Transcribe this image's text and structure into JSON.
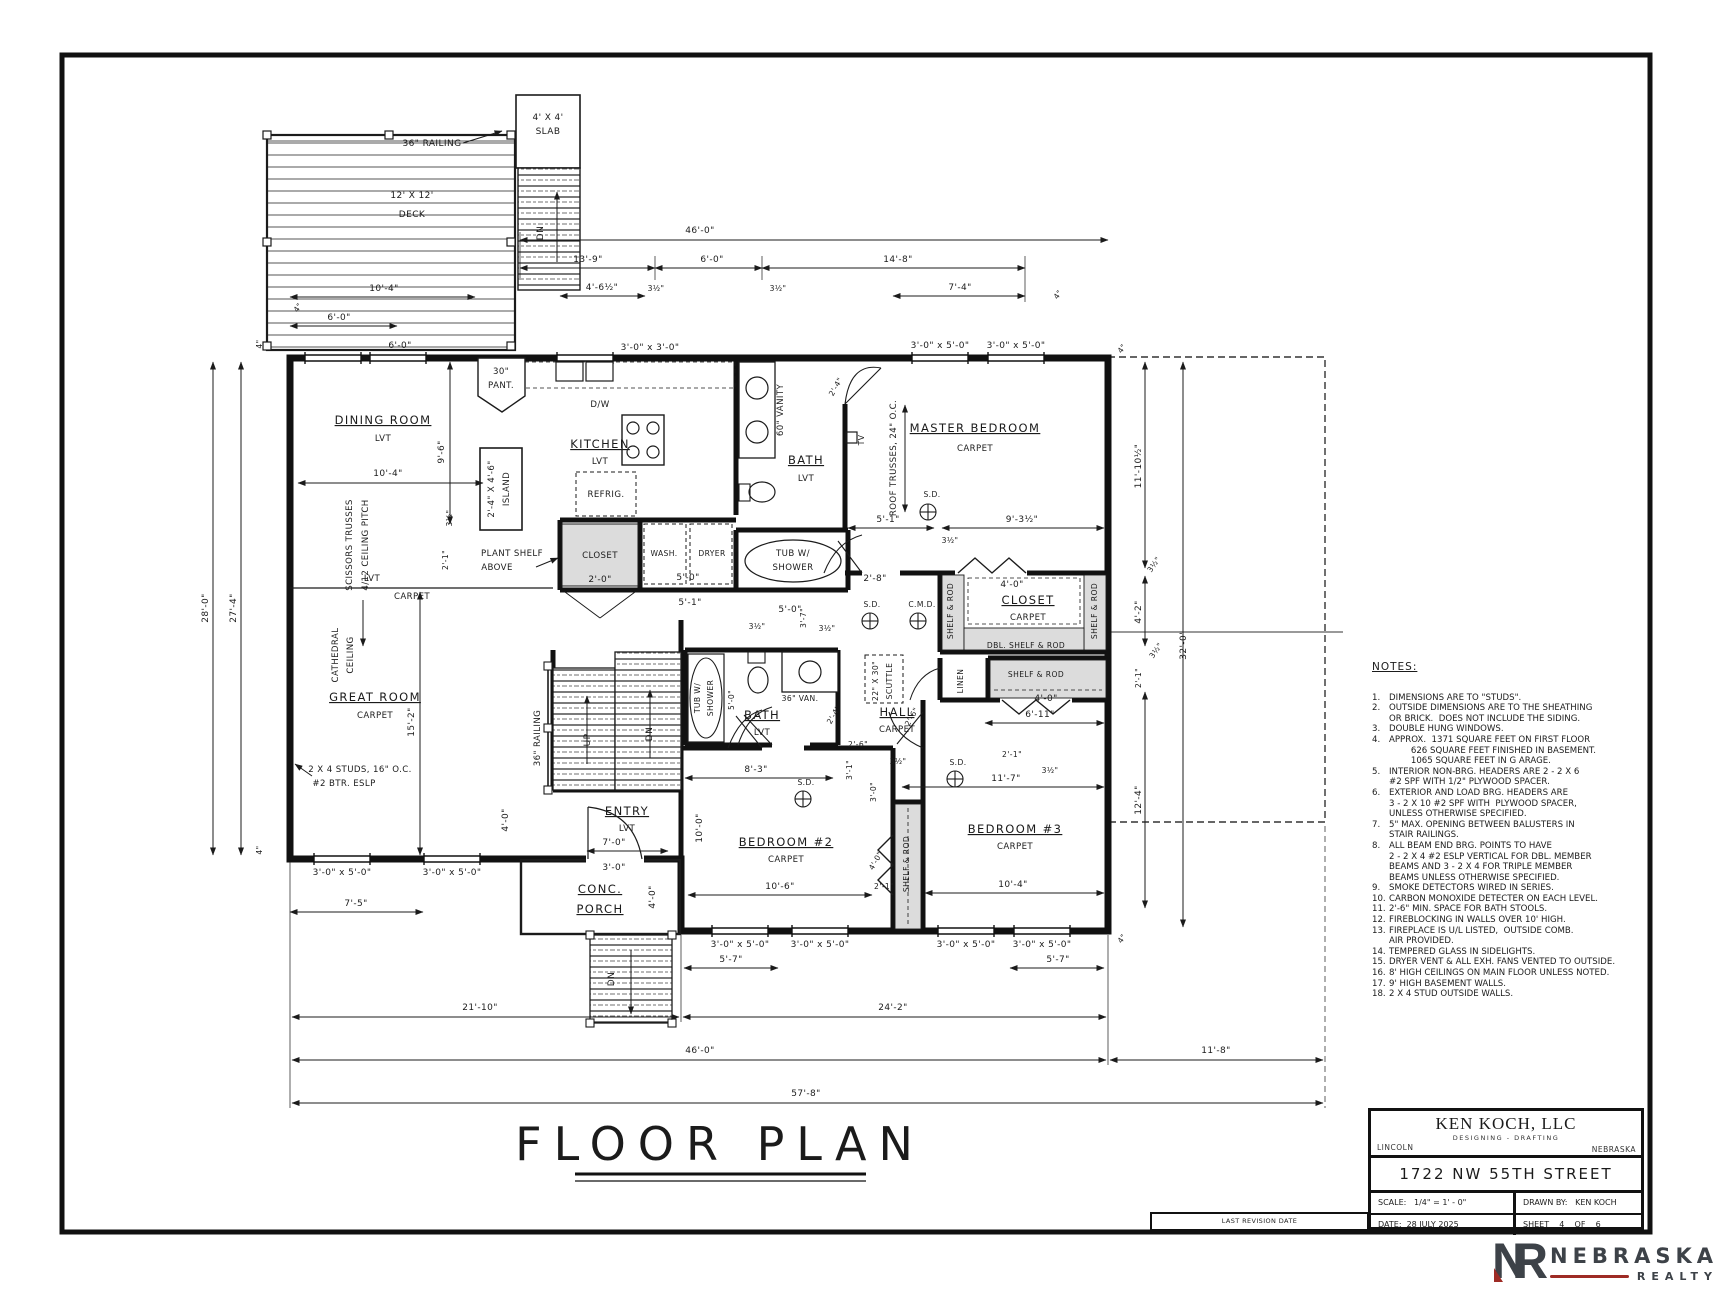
{
  "sheet": {
    "plan_title": "FLOOR PLAN"
  },
  "colors": {
    "line": "#1b1b1b",
    "shade": "#dcdcdc",
    "logo_gray": "#3d4248",
    "logo_red": "#9e2b25"
  },
  "title_block": {
    "company": "KEN KOCH, LLC",
    "company_sub": "DESIGNING - DRAFTING",
    "city": "LINCOLN",
    "state": "NEBRASKA",
    "address": "1722 NW 55TH STREET",
    "scale": "SCALE:   1/4\" = 1' - 0\"",
    "drawn_by": "DRAWN BY:   KEN KOCH",
    "date": "DATE:  28 JULY 2025",
    "sheet": "SHEET    4    OF    6",
    "revision": "LAST REVISION DATE"
  },
  "logo": {
    "monogram_n": "N",
    "monogram_r": "R",
    "name": "NEBRASKA",
    "sub": "REALTY"
  },
  "notes": {
    "title": "NOTES:",
    "items": [
      {
        "num": "1.",
        "lines": [
          "DIMENSIONS ARE TO \"STUDS\"."
        ]
      },
      {
        "num": "2.",
        "lines": [
          "OUTSIDE DIMENSIONS ARE TO THE SHEATHING",
          "OR BRICK.  DOES NOT INCLUDE THE SIDING."
        ]
      },
      {
        "num": "3.",
        "lines": [
          "DOUBLE HUNG WINDOWS."
        ]
      },
      {
        "num": "4.",
        "lines": [
          "APPROX.  1371 SQUARE FEET ON FIRST FLOOR",
          "        626 SQUARE FEET FINISHED IN BASEMENT.",
          "        1065 SQUARE FEET IN G ARAGE."
        ]
      },
      {
        "num": "5.",
        "lines": [
          "INTERIOR NON-BRG. HEADERS ARE 2 - 2 X 6",
          "#2 SPF WITH 1/2\" PLYWOOD SPACER."
        ]
      },
      {
        "num": "6.",
        "lines": [
          "EXTERIOR AND LOAD BRG. HEADERS ARE",
          "3 - 2 X 10 #2 SPF WITH  PLYWOOD SPACER,",
          "UNLESS OTHERWISE SPECIFIED."
        ]
      },
      {
        "num": "7.",
        "lines": [
          "5\" MAX. OPENING BETWEEN BALUSTERS IN",
          "STAIR RAILINGS."
        ]
      },
      {
        "num": "8.",
        "lines": [
          "ALL BEAM END BRG. POINTS TO HAVE",
          "2 - 2 X 4 #2 ESLP VERTICAL FOR DBL. MEMBER",
          "BEAMS AND 3 - 2 X 4 FOR TRIPLE MEMBER",
          "BEAMS UNLESS OTHERWISE SPECIFIED."
        ]
      },
      {
        "num": "9.",
        "lines": [
          "SMOKE DETECTORS WIRED IN SERIES."
        ]
      },
      {
        "num": "10.",
        "lines": [
          "CARBON MONOXIDE DETECTER ON EACH LEVEL."
        ]
      },
      {
        "num": "11.",
        "lines": [
          "2'-6\" MIN. SPACE FOR BATH STOOLS."
        ]
      },
      {
        "num": "12.",
        "lines": [
          "FIREBLOCKING IN WALLS OVER 10' HIGH."
        ]
      },
      {
        "num": "13.",
        "lines": [
          "FIREPLACE IS U/L LISTED,  OUTSIDE COMB.",
          "AIR PROVIDED."
        ]
      },
      {
        "num": "14.",
        "lines": [
          "TEMPERED GLASS IN SIDELIGHTS."
        ]
      },
      {
        "num": "15.",
        "lines": [
          "DRYER VENT & ALL EXH. FANS VENTED TO OUTSIDE."
        ]
      },
      {
        "num": "16.",
        "lines": [
          "8' HIGH CEILINGS ON MAIN FLOOR UNLESS NOTED."
        ]
      },
      {
        "num": "17.",
        "lines": [
          "9' HIGH BASEMENT WALLS."
        ]
      },
      {
        "num": "18.",
        "lines": [
          "2 X 4 STUD OUTSIDE WALLS."
        ]
      }
    ]
  },
  "plan": {
    "annotations": [
      {
        "t": "36\" RAILING",
        "x": 432,
        "y": 146,
        "c": "d"
      },
      {
        "t": "12' X 12'",
        "x": 412,
        "y": 198,
        "c": "d"
      },
      {
        "t": "DECK",
        "x": 412,
        "y": 217,
        "c": "d"
      },
      {
        "t": "4' X 4'",
        "x": 548,
        "y": 120,
        "c": "d"
      },
      {
        "t": "SLAB",
        "x": 548,
        "y": 134,
        "c": "d"
      },
      {
        "t": "DN",
        "x": 543,
        "y": 233,
        "r": -90,
        "c": "d"
      },
      {
        "t": "10'-4\"",
        "x": 384,
        "y": 291,
        "c": "d"
      },
      {
        "t": "4\"",
        "x": 300,
        "y": 309,
        "r": -55,
        "c": "t"
      },
      {
        "t": "6'-0\"",
        "x": 339,
        "y": 320,
        "c": "d"
      },
      {
        "t": "6'-0\"",
        "x": 400,
        "y": 348,
        "c": "d"
      },
      {
        "t": "46'-0\"",
        "x": 700,
        "y": 233,
        "c": "d"
      },
      {
        "t": "13'-9\"",
        "x": 588,
        "y": 262,
        "c": "d"
      },
      {
        "t": "6'-0\"",
        "x": 712,
        "y": 262,
        "c": "d"
      },
      {
        "t": "14'-8\"",
        "x": 898,
        "y": 262,
        "c": "d"
      },
      {
        "t": "4'-6½\"",
        "x": 602,
        "y": 290,
        "c": "d"
      },
      {
        "t": "3½\"",
        "x": 656,
        "y": 291,
        "c": "t"
      },
      {
        "t": "3½\"",
        "x": 778,
        "y": 291,
        "c": "t"
      },
      {
        "t": "7'-4\"",
        "x": 960,
        "y": 290,
        "c": "d"
      },
      {
        "t": "4\"",
        "x": 1060,
        "y": 296,
        "r": -55,
        "c": "t"
      },
      {
        "t": "3'-0\" x 3'-0\"",
        "x": 650,
        "y": 350,
        "c": "d"
      },
      {
        "t": "3'-0\" x 5'-0\"",
        "x": 940,
        "y": 348,
        "c": "d"
      },
      {
        "t": "3'-0\" x 5'-0\"",
        "x": 1016,
        "y": 348,
        "c": "d"
      },
      {
        "t": "4\"",
        "x": 262,
        "y": 344,
        "r": -90,
        "c": "t"
      },
      {
        "t": "28'-0\"",
        "x": 208,
        "y": 608,
        "r": -90,
        "c": "d"
      },
      {
        "t": "27'-4\"",
        "x": 236,
        "y": 608,
        "r": -90,
        "c": "d"
      },
      {
        "t": "4\"",
        "x": 262,
        "y": 850,
        "r": -90,
        "c": "t"
      },
      {
        "t": "DINING ROOM",
        "x": 383,
        "y": 424,
        "c": "r"
      },
      {
        "t": "LVT",
        "x": 383,
        "y": 441,
        "c": "s"
      },
      {
        "t": "10'-4\"",
        "x": 388,
        "y": 476,
        "c": "d"
      },
      {
        "t": "9'-6\"",
        "x": 444,
        "y": 452,
        "r": -90,
        "c": "d"
      },
      {
        "t": "3½\"",
        "x": 452,
        "y": 518,
        "r": -90,
        "c": "t"
      },
      {
        "t": "2'-1\"",
        "x": 448,
        "y": 560,
        "r": -90,
        "c": "t"
      },
      {
        "t": "SCISSORS TRUSSES",
        "x": 352,
        "y": 545,
        "r": -90,
        "c": "s"
      },
      {
        "t": "4/12 CEILING PITCH",
        "x": 368,
        "y": 545,
        "r": -90,
        "c": "s"
      },
      {
        "t": "LVT",
        "x": 372,
        "y": 581,
        "c": "s"
      },
      {
        "t": "CARPET",
        "x": 412,
        "y": 599,
        "c": "s"
      },
      {
        "t": "CATHEDRAL",
        "x": 338,
        "y": 655,
        "r": -90,
        "c": "s"
      },
      {
        "t": "CEILING",
        "x": 353,
        "y": 655,
        "r": -90,
        "c": "s"
      },
      {
        "t": "GREAT ROOM",
        "x": 375,
        "y": 701,
        "c": "r"
      },
      {
        "t": "CARPET",
        "x": 375,
        "y": 718,
        "c": "s"
      },
      {
        "t": "15'-2\"",
        "x": 414,
        "y": 722,
        "r": -90,
        "c": "d"
      },
      {
        "t": "2 X 4 STUDS, 16\" O.C.",
        "x": 360,
        "y": 772,
        "c": "s"
      },
      {
        "t": "#2 BTR. ESLP",
        "x": 344,
        "y": 786,
        "c": "s"
      },
      {
        "t": "30\"",
        "x": 501,
        "y": 374,
        "c": "s"
      },
      {
        "t": "PANT.",
        "x": 501,
        "y": 388,
        "c": "s"
      },
      {
        "t": "D/W",
        "x": 600,
        "y": 407,
        "c": "s"
      },
      {
        "t": "KITCHEN",
        "x": 600,
        "y": 448,
        "c": "r"
      },
      {
        "t": "LVT",
        "x": 600,
        "y": 464,
        "c": "s"
      },
      {
        "t": "2'-4\" X 4'-6\"",
        "x": 494,
        "y": 489,
        "r": -90,
        "c": "s"
      },
      {
        "t": "ISLAND",
        "x": 509,
        "y": 489,
        "r": -90,
        "c": "s"
      },
      {
        "t": "REFRIG.",
        "x": 606,
        "y": 497,
        "c": "s"
      },
      {
        "t": "PLANT SHELF",
        "x": 512,
        "y": 556,
        "c": "s"
      },
      {
        "t": "ABOVE",
        "x": 497,
        "y": 570,
        "c": "s"
      },
      {
        "t": "CLOSET",
        "x": 600,
        "y": 558,
        "c": "s"
      },
      {
        "t": "2'-0\"",
        "x": 600,
        "y": 582,
        "c": "d"
      },
      {
        "t": "WASH.",
        "x": 664,
        "y": 556,
        "c": "t"
      },
      {
        "t": "DRYER",
        "x": 712,
        "y": 556,
        "c": "t"
      },
      {
        "t": "5'-0\"",
        "x": 688,
        "y": 580,
        "c": "d"
      },
      {
        "t": "5'-1\"",
        "x": 690,
        "y": 605,
        "c": "d"
      },
      {
        "t": "5'-0\"",
        "x": 790,
        "y": 612,
        "c": "d"
      },
      {
        "t": "3½\"",
        "x": 757,
        "y": 629,
        "c": "t"
      },
      {
        "t": "3½\"",
        "x": 827,
        "y": 631,
        "c": "t"
      },
      {
        "t": "3'-7\"",
        "x": 806,
        "y": 618,
        "r": -90,
        "c": "t"
      },
      {
        "t": "60\" VANITY",
        "x": 783,
        "y": 410,
        "r": -90,
        "c": "s"
      },
      {
        "t": "BATH",
        "x": 806,
        "y": 464,
        "c": "r"
      },
      {
        "t": "LVT",
        "x": 806,
        "y": 481,
        "c": "s"
      },
      {
        "t": "TUB  W/",
        "x": 793,
        "y": 556,
        "c": "s"
      },
      {
        "t": "SHOWER",
        "x": 793,
        "y": 570,
        "c": "s"
      },
      {
        "t": "2'-4\"",
        "x": 838,
        "y": 388,
        "r": -60,
        "c": "t"
      },
      {
        "t": "MASTER BEDROOM",
        "x": 975,
        "y": 432,
        "c": "r"
      },
      {
        "t": "CARPET",
        "x": 975,
        "y": 451,
        "c": "s"
      },
      {
        "t": "ROOF TRUSSES, 24\" O.C.",
        "x": 896,
        "y": 458,
        "r": -90,
        "c": "s"
      },
      {
        "t": "TV",
        "x": 864,
        "y": 440,
        "r": -90,
        "c": "t"
      },
      {
        "t": "S.D.",
        "x": 932,
        "y": 497,
        "c": "t"
      },
      {
        "t": "5'-1\"",
        "x": 888,
        "y": 522,
        "c": "d"
      },
      {
        "t": "9'-3½\"",
        "x": 1022,
        "y": 522,
        "c": "d"
      },
      {
        "t": "3½\"",
        "x": 950,
        "y": 543,
        "c": "t"
      },
      {
        "t": "2'-8\"",
        "x": 875,
        "y": 581,
        "c": "d"
      },
      {
        "t": "4'-0\"",
        "x": 1012,
        "y": 587,
        "c": "d"
      },
      {
        "t": "CLOSET",
        "x": 1028,
        "y": 604,
        "c": "r"
      },
      {
        "t": "CARPET",
        "x": 1028,
        "y": 620,
        "c": "s"
      },
      {
        "t": "SHELF & ROD",
        "x": 953,
        "y": 611,
        "r": -90,
        "c": "t"
      },
      {
        "t": "SHELF & ROD",
        "x": 1097,
        "y": 611,
        "r": -90,
        "c": "t"
      },
      {
        "t": "DBL.  SHELF & ROD",
        "x": 1026,
        "y": 648,
        "c": "t"
      },
      {
        "t": "LINEN",
        "x": 963,
        "y": 681,
        "r": -90,
        "c": "t"
      },
      {
        "t": "SHELF & ROD",
        "x": 1036,
        "y": 677,
        "c": "t"
      },
      {
        "t": "4'-0\"",
        "x": 1046,
        "y": 701,
        "c": "d"
      },
      {
        "t": "S.D.",
        "x": 872,
        "y": 607,
        "c": "t"
      },
      {
        "t": "C.M.D.",
        "x": 922,
        "y": 607,
        "c": "t"
      },
      {
        "t": "22\" X 30\"",
        "x": 878,
        "y": 681,
        "r": -90,
        "c": "t"
      },
      {
        "t": "SCUTTLE",
        "x": 892,
        "y": 681,
        "r": -90,
        "c": "t"
      },
      {
        "t": "HALL",
        "x": 897,
        "y": 716,
        "c": "r"
      },
      {
        "t": "CARPET",
        "x": 897,
        "y": 732,
        "c": "s"
      },
      {
        "t": "2'-6\"",
        "x": 858,
        "y": 747,
        "c": "t"
      },
      {
        "t": "2'-6\"",
        "x": 914,
        "y": 718,
        "r": -60,
        "c": "t"
      },
      {
        "t": "3½\"",
        "x": 898,
        "y": 764,
        "c": "t"
      },
      {
        "t": "3'-1\"",
        "x": 852,
        "y": 770,
        "r": -90,
        "c": "t"
      },
      {
        "t": "3'-0\"",
        "x": 876,
        "y": 792,
        "r": -90,
        "c": "t"
      },
      {
        "t": "S.D.",
        "x": 958,
        "y": 765,
        "c": "t"
      },
      {
        "t": "2'-1\"",
        "x": 1012,
        "y": 757,
        "c": "t"
      },
      {
        "t": "3½\"",
        "x": 1050,
        "y": 773,
        "c": "t"
      },
      {
        "t": "11'-7\"",
        "x": 1006,
        "y": 781,
        "c": "d"
      },
      {
        "t": "6'-11\"",
        "x": 1040,
        "y": 717,
        "c": "d"
      },
      {
        "t": "TUB  W/",
        "x": 700,
        "y": 698,
        "r": -90,
        "c": "t"
      },
      {
        "t": "SHOWER",
        "x": 713,
        "y": 698,
        "r": -90,
        "c": "t"
      },
      {
        "t": "5'-0\"",
        "x": 734,
        "y": 700,
        "r": -90,
        "c": "t"
      },
      {
        "t": "36\" VAN.",
        "x": 800,
        "y": 701,
        "c": "t"
      },
      {
        "t": "BATH",
        "x": 762,
        "y": 719,
        "c": "r"
      },
      {
        "t": "LVT",
        "x": 762,
        "y": 735,
        "c": "s"
      },
      {
        "t": "2'-4\"",
        "x": 836,
        "y": 716,
        "r": -60,
        "c": "t"
      },
      {
        "t": "36\" RAILING",
        "x": 540,
        "y": 738,
        "r": -90,
        "c": "s"
      },
      {
        "t": "UP",
        "x": 590,
        "y": 740,
        "r": -90,
        "c": "d"
      },
      {
        "t": "DN",
        "x": 652,
        "y": 734,
        "r": -90,
        "c": "d"
      },
      {
        "t": "ENTRY",
        "x": 627,
        "y": 815,
        "c": "r"
      },
      {
        "t": "LVT",
        "x": 627,
        "y": 831,
        "c": "s"
      },
      {
        "t": "7'-0\"",
        "x": 614,
        "y": 845,
        "c": "d"
      },
      {
        "t": "3'-0\"",
        "x": 614,
        "y": 870,
        "c": "d"
      },
      {
        "t": "4'-0\"",
        "x": 508,
        "y": 820,
        "r": -90,
        "c": "d"
      },
      {
        "t": "CONC.",
        "x": 600,
        "y": 893,
        "c": "r"
      },
      {
        "t": "PORCH",
        "x": 600,
        "y": 913,
        "c": "r"
      },
      {
        "t": "4'-0\"",
        "x": 655,
        "y": 897,
        "r": -90,
        "c": "d"
      },
      {
        "t": "DN",
        "x": 614,
        "y": 979,
        "r": -90,
        "c": "d"
      },
      {
        "t": "8'-3\"",
        "x": 756,
        "y": 772,
        "c": "d"
      },
      {
        "t": "S.D.",
        "x": 806,
        "y": 785,
        "c": "t"
      },
      {
        "t": "10'-0\"",
        "x": 702,
        "y": 828,
        "r": -90,
        "c": "d"
      },
      {
        "t": "BEDROOM #2",
        "x": 786,
        "y": 846,
        "c": "r"
      },
      {
        "t": "CARPET",
        "x": 786,
        "y": 862,
        "c": "s"
      },
      {
        "t": "10'-6\"",
        "x": 780,
        "y": 889,
        "c": "d"
      },
      {
        "t": "4'-0\"",
        "x": 878,
        "y": 862,
        "r": -60,
        "c": "t"
      },
      {
        "t": "SHELF & ROD",
        "x": 909,
        "y": 864,
        "r": -90,
        "c": "t"
      },
      {
        "t": "2'-1\"",
        "x": 884,
        "y": 889,
        "c": "t"
      },
      {
        "t": "BEDROOM #3",
        "x": 1015,
        "y": 833,
        "c": "r"
      },
      {
        "t": "CARPET",
        "x": 1015,
        "y": 849,
        "c": "s"
      },
      {
        "t": "10'-4\"",
        "x": 1013,
        "y": 887,
        "c": "d"
      },
      {
        "t": "3'-0\" x 5'-0\"",
        "x": 342,
        "y": 875,
        "c": "d"
      },
      {
        "t": "3'-0\" x 5'-0\"",
        "x": 452,
        "y": 875,
        "c": "d"
      },
      {
        "t": "7'-5\"",
        "x": 356,
        "y": 906,
        "c": "d"
      },
      {
        "t": "3'-0\" x 5'-0\"",
        "x": 740,
        "y": 947,
        "c": "d"
      },
      {
        "t": "3'-0\" x 5'-0\"",
        "x": 820,
        "y": 947,
        "c": "d"
      },
      {
        "t": "3'-0\" x 5'-0\"",
        "x": 966,
        "y": 947,
        "c": "d"
      },
      {
        "t": "3'-0\" x 5'-0\"",
        "x": 1042,
        "y": 947,
        "c": "d"
      },
      {
        "t": "5'-7\"",
        "x": 731,
        "y": 962,
        "c": "d"
      },
      {
        "t": "5'-7\"",
        "x": 1058,
        "y": 962,
        "c": "d"
      },
      {
        "t": "21'-10\"",
        "x": 480,
        "y": 1010,
        "c": "d"
      },
      {
        "t": "24'-2\"",
        "x": 893,
        "y": 1010,
        "c": "d"
      },
      {
        "t": "46'-0\"",
        "x": 700,
        "y": 1053,
        "c": "d"
      },
      {
        "t": "11'-8\"",
        "x": 1216,
        "y": 1053,
        "c": "d"
      },
      {
        "t": "57'-8\"",
        "x": 806,
        "y": 1096,
        "c": "d"
      },
      {
        "t": "4\"",
        "x": 1124,
        "y": 350,
        "r": -55,
        "c": "t"
      },
      {
        "t": "11'-10½\"",
        "x": 1141,
        "y": 466,
        "r": -90,
        "c": "d"
      },
      {
        "t": "3½\"",
        "x": 1156,
        "y": 566,
        "r": -55,
        "c": "t"
      },
      {
        "t": "4'-2\"",
        "x": 1141,
        "y": 612,
        "r": -90,
        "c": "d"
      },
      {
        "t": "3½\"",
        "x": 1158,
        "y": 652,
        "r": -55,
        "c": "t"
      },
      {
        "t": "2'-1\"",
        "x": 1141,
        "y": 678,
        "r": -90,
        "c": "t"
      },
      {
        "t": "12'-4\"",
        "x": 1141,
        "y": 800,
        "r": -90,
        "c": "d"
      },
      {
        "t": "32'-0\"",
        "x": 1186,
        "y": 645,
        "r": -90,
        "c": "d"
      },
      {
        "t": "4\"",
        "x": 1124,
        "y": 940,
        "r": -55,
        "c": "t"
      }
    ]
  }
}
